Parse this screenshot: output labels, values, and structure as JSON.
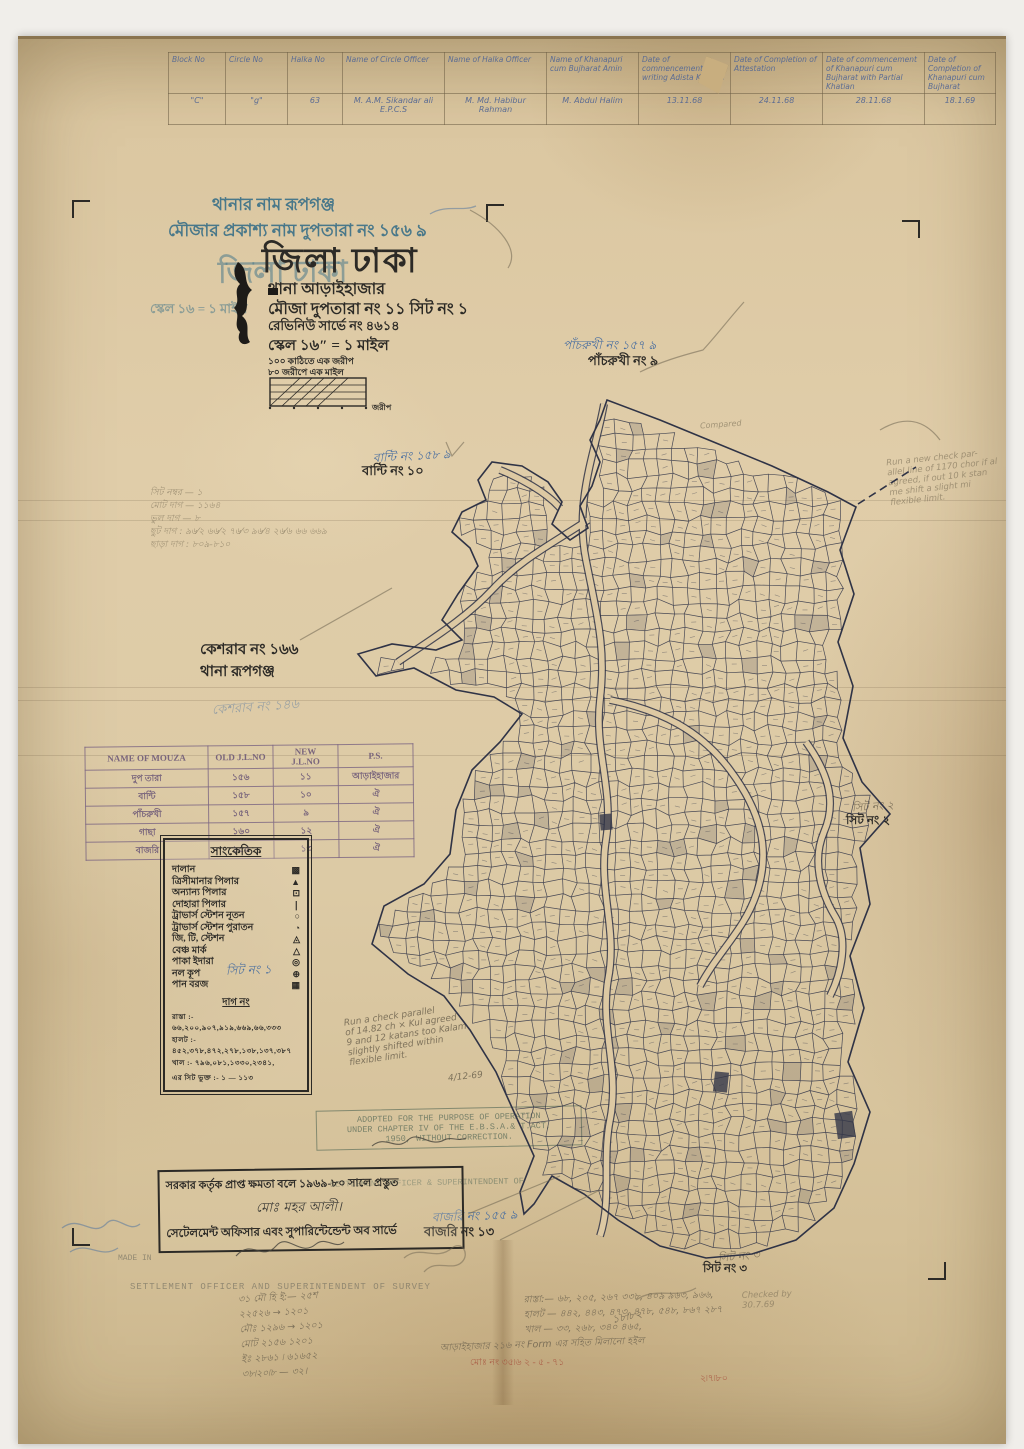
{
  "colors": {
    "paper": "#ddc9a3",
    "map_ink": "#2f3346",
    "blue_ink": "#4a6fa0",
    "teal_print": "#49788a",
    "pencil": "#7d7460",
    "stamp_purple": "#7a6482",
    "stamp_green": "#6e7a64",
    "red_pencil": "#a8543f"
  },
  "top_table": {
    "headers": [
      "Block No",
      "Circle No",
      "Halka No",
      "Name of Circle Officer",
      "Name of Halka Officer",
      "Name of Khanapuri cum Bujharat Amin",
      "Date of commencement of writing Adista Khatian",
      "Date of Completion of Attestation",
      "Date of commencement of Khanapuri cum Bujharat with Partial Khatian",
      "Date of Completion of Khanapuri cum Bujharat"
    ],
    "row": [
      "\"C\"",
      "\"g\"",
      "63",
      "M. A.M. Sikandar ali E.P.C.S",
      "M. Md. Habibur Rahman",
      "M. Abdul Halim",
      "13.11.68",
      "24.11.68",
      "28.11.68",
      "18.1.69"
    ]
  },
  "title_block": {
    "thana_line": "থানার নাম   রূপগঞ্জ",
    "mouza_pub_line": "মৌজার প্রকাশ্য নাম   দুপতারা নং ১৫৬ ঌ",
    "district_title": "জিলা ঢাকা",
    "district_ghost": "জিলা ঢাকা",
    "thana_line2": "থানা   আড়াইহাজার",
    "mouza_line2": "মৌজা    দুপতারা নং ১১ সিট নং ১",
    "revenue_line": "রেভিনিউ সার্ভে নং ৪৬১৪",
    "scale_line": "স্কেল ১৬″ = ১ মাইল",
    "scale_ghost": "স্কেল ১৬ = ১ মাইল",
    "scale_sub1": "১০০ কাঠিতে এক জরীপ",
    "scale_sub2": "৮০ জরীপে এক মাইল",
    "scale_bar_unit": "জরীপ"
  },
  "pencil_list": {
    "l1": "সিট নম্বর  —  ১",
    "l2": "মোট দাগ  —  ১১৬৪",
    "l3": "ভুল দাগ  —  ৮",
    "l4": "ছুট দাগ  :  ৯৬⁄২  ৬৬⁄২  ৭৬⁄৩  ৯৬⁄৪  ২৬⁄৬  ৬৬ ৬৬৯",
    "l5": "ছাড়া দাগ :  ৮০৯-৮১০"
  },
  "neighbors": {
    "kesharab1": "কেশরাব নং ১৬৬",
    "kesharab2": "থানা  রূপগঞ্জ",
    "kesharab_faint": "কেশরাব নং ১৪৬",
    "banti_blue": "বান্টি নং ১৫৮ ঌ",
    "banti_black": "বান্টি নং ১০",
    "pachrukhi_blue": "পাঁচরুখী নং ১৫৭ ঌ",
    "pachrukhi_black": "পাঁচরুখী নং ৯",
    "sheet2_pencil": "সিট নং ২",
    "sheet2_black": "সিট নং ২",
    "bazari_blue": "বাজরি নং ১৫৫ ঌ",
    "bazari_black": "বাজরি নং ১৩",
    "sheet3_pencil": "সিট নং ৩",
    "sheet3_black": "সিট নং ৩"
  },
  "mouza_table": {
    "h1": "NAME OF MOUZA",
    "h2": "OLD J.L.NO",
    "h3": "NEW J.L.NO",
    "h4": "P.S.",
    "rows": [
      {
        "c1": "দুপ তারা",
        "c2": "১৫৬",
        "c3": "১১",
        "c4": "আড়াইহাজার"
      },
      {
        "c1": "বান্টি",
        "c2": "১৫৮",
        "c3": "১০",
        "c4": "ঐ"
      },
      {
        "c1": "পাঁচরুখী",
        "c2": "১৫৭",
        "c3": "৯",
        "c4": "ঐ"
      },
      {
        "c1": "গাছা",
        "c2": "১৬০",
        "c3": "১২",
        "c4": "ঐ"
      },
      {
        "c1": "বাজরি",
        "c2": "১৫৫",
        "c3": "১৩",
        "c4": "ঐ"
      }
    ]
  },
  "legend": {
    "title": "সাংকেতিক",
    "items": [
      {
        "label": "দালান",
        "symbol": "▩"
      },
      {
        "label": "ত্রিসীমানার পিলার",
        "symbol": "▲"
      },
      {
        "label": "অন্যান্য পিলার",
        "symbol": "⊡"
      },
      {
        "label": "দোহারা পিলার",
        "symbol": "❘"
      },
      {
        "label": "ট্রাভার্স স্টেশন নূতন",
        "symbol": "○"
      },
      {
        "label": "ট্রাভার্স স্টেশন পুরাতন",
        "symbol": "◔"
      },
      {
        "label": "জি, টি, স্টেশন",
        "symbol": "◬"
      },
      {
        "label": "বেঞ্চ মার্ক",
        "symbol": "△"
      },
      {
        "label": "পাকা ইদারা",
        "symbol": "◎"
      },
      {
        "label": "নল কূপ",
        "symbol": "⊕"
      },
      {
        "label": "পান বরজ",
        "symbol": "▦"
      }
    ],
    "dag_heading": "দাগ নং",
    "d1": "রাস্তা :- ৬৬,২০০,৯০৭,৯১৯,৬৬৯,৬৬,৩৩৩",
    "d2": "হালট :- ৪৫২,৩৭৮,৪৭২,২৭৮,১৩৮,১৩৭,৩৮৭",
    "d3": "খাল :- ৭৯৬,০৮১,১৩৩০,২৩৪১,",
    "d4": "এর সিট ভুক্ত :- ১ — ১১৩",
    "overlay_note": "সিট নং ১"
  },
  "stamps": {
    "adopted": "ADOPTED FOR THE PURPOSE OF OPERATION\nUNDER CHAPTER IV OF THE E.B.S.A.& T.ACT,\n1950, WITHOUT CORRECTION.",
    "so_partial": "SETTLEMENT OFFICER & SUPERINTENDENT OF",
    "box_line1": "সরকার কর্তৃক প্রাপ্ত ক্ষমতা বলে ১৯৬৯-৮০ সালে প্রস্তুত",
    "box_sig": "মোঃ মহর আলী।",
    "box_line2": "সেটেলমেন্ট অফিসার এবং সুপারিন্টেন্ডেন্ট অব সার্ভে",
    "made_in": "MADE IN",
    "survey_stamp": "SETTLEMENT OFFICER AND SUPERINTENDENT OF SURVEY"
  },
  "notes": {
    "right_margin": "Run a new check par-\nallel line of 1170 chor if al\nagreed, if out 10 k stan\nme shift a slight mi\nflexible limit.",
    "mid_note": "Run a check parallel\nof 14.82 ch × Kul agreed\n9 and 12 katans too Kalam\nslightly shifted within\nflexible limit.",
    "mid_date": "4/12-69",
    "compared": "Compared",
    "checked": "Checked by\n30.7.69",
    "bottom_right": "রাস্তা:— ৬৮, ২০৫, ২৬৭ ৩৩৮, ৪০৯ ৯৬৩, ৯৬৬,\nহালট — ৪৪২, ৪৪৩, ৪৭৩, ৪৭৮, ৫৪৮, ৮৬৭ ২৮৭\nখাল — ৩৩, ২৬৮, ৩৪০ ৪৬৫,",
    "bottom_right2": "আড়াইহাজার ২১৬ নং Form এর সহিত মিলানো হইল",
    "red_line": "মোঃ নং ৩৫৷৬   ২ - ৫ - ৭১",
    "red_date": "২৷৭৷৮০",
    "bottom_left": "৩১ মৌ হি ই:— ২৫শ\n২২৫২৬ → ১২০১\nমৌঃ ১২৯৬ → ১২০১\nমোট ২১৫৬ ১২০১\nইঃ ২৮৬১ ৷ ৬১৬৫২\n৩৮৷২০৷৮ — ৩২।",
    "bottom_left_date": "১৮৷৮২"
  }
}
